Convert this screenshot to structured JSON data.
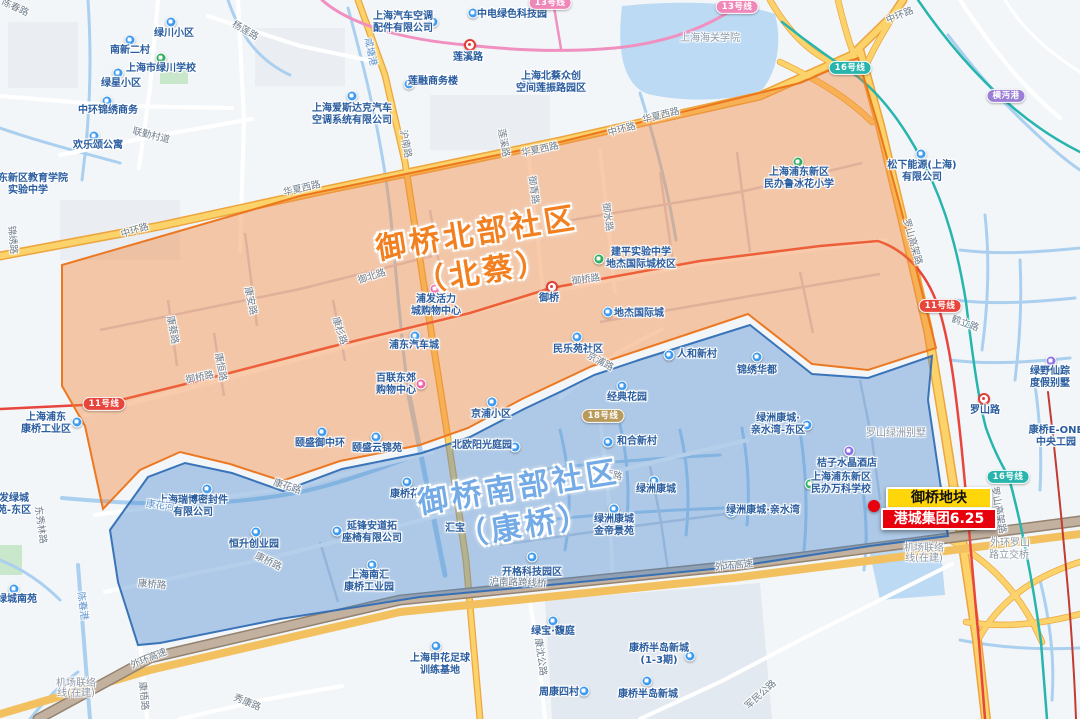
{
  "map": {
    "region_labels": [
      {
        "lines": [
          "御桥北部社区",
          "（北蔡）"
        ],
        "x": 480,
        "y": 253,
        "rot": -9,
        "color": "#f28020"
      },
      {
        "lines": [
          "御桥南部社区",
          "（康桥）"
        ],
        "x": 522,
        "y": 507,
        "rot": -9,
        "color": "#74abe6"
      }
    ],
    "annotation": {
      "dot": {
        "x": 874,
        "y": 506
      },
      "badges": [
        {
          "text": "御桥地块",
          "x": 939,
          "y": 498,
          "w": 102,
          "bg": "#ffd60a",
          "color": "#111111"
        },
        {
          "text": "港城集团6.25",
          "x": 939,
          "y": 519,
          "w": 112,
          "bg": "#e8000d",
          "color": "#ffffff"
        }
      ]
    },
    "stations": [
      {
        "name": "莲溪路",
        "x": 470,
        "y": 45,
        "lx": 468,
        "ly": 58
      },
      {
        "name": "御桥",
        "x": 552,
        "y": 287,
        "lx": 549,
        "ly": 299
      },
      {
        "name": "罗山路",
        "x": 984,
        "y": 399,
        "lx": 985,
        "ly": 411
      }
    ],
    "metro_badges": [
      {
        "t": "11号线",
        "x": 104,
        "y": 404,
        "c": "#e8453c"
      },
      {
        "t": "11号线",
        "x": 940,
        "y": 306,
        "c": "#e8453c"
      },
      {
        "t": "13号线",
        "x": 550,
        "y": 3,
        "c": "#f087b9"
      },
      {
        "t": "13号线",
        "x": 737,
        "y": 7,
        "c": "#f087b9"
      },
      {
        "t": "16号线",
        "x": 850,
        "y": 68,
        "c": "#27b5ad"
      },
      {
        "t": "16号线",
        "x": 1008,
        "y": 477,
        "c": "#27b5ad"
      },
      {
        "t": "18号线",
        "x": 603,
        "y": 416,
        "c": "#b89a5a"
      },
      {
        "t": "横沔港",
        "x": 1006,
        "y": 96,
        "c": "#9b7fd4"
      }
    ],
    "pois": [
      {
        "lines": [
          "南新二村"
        ],
        "x": 130,
        "y": 51,
        "icon": {
          "x": 130,
          "y": 40,
          "type": "building"
        }
      },
      {
        "lines": [
          "绿星小区"
        ],
        "x": 121,
        "y": 84,
        "icon": {
          "x": 118,
          "y": 73,
          "type": "building"
        }
      },
      {
        "lines": [
          "绿川小区"
        ],
        "x": 174,
        "y": 34,
        "icon": {
          "x": 171,
          "y": 22,
          "type": "building"
        }
      },
      {
        "lines": [
          "上海市绿川学校"
        ],
        "x": 161,
        "y": 69,
        "icon": {
          "x": 161,
          "y": 58,
          "type": "school"
        }
      },
      {
        "lines": [
          "中环锦绣商务"
        ],
        "x": 108,
        "y": 111,
        "icon": {
          "x": 107,
          "y": 101,
          "type": "building"
        }
      },
      {
        "lines": [
          "欢乐颂公寓"
        ],
        "x": 98,
        "y": 146,
        "icon": {
          "x": 94,
          "y": 136,
          "type": "building"
        }
      },
      {
        "lines": [
          "浦东新区教育学院",
          "实验中学"
        ],
        "x": 28,
        "y": 179
      },
      {
        "lines": [
          "上海汽车空调",
          "配件有限公司"
        ],
        "x": 403,
        "y": 17,
        "icon": {
          "x": 433,
          "y": 22,
          "type": "building"
        }
      },
      {
        "lines": [
          "中电绿色科技园"
        ],
        "x": 512,
        "y": 15,
        "icon": {
          "x": 473,
          "y": 13,
          "type": "building"
        }
      },
      {
        "lines": [
          "莲融商务楼"
        ],
        "x": 433,
        "y": 82,
        "icon": {
          "x": 409,
          "y": 84,
          "type": "building"
        }
      },
      {
        "lines": [
          "上海北蔡众创",
          "空间莲振路园区"
        ],
        "x": 551,
        "y": 77,
        "icon": {
          "x": 527,
          "y": 80,
          "type": "building"
        }
      },
      {
        "lines": [
          "上海爱斯达克汽车",
          "空调系统有限公司"
        ],
        "x": 352,
        "y": 109,
        "icon": {
          "x": 352,
          "y": 96,
          "type": "building"
        }
      },
      {
        "lines": [
          "松下能源(上海)",
          "有限公司"
        ],
        "x": 922,
        "y": 166,
        "icon": {
          "x": 921,
          "y": 154,
          "type": "building"
        }
      },
      {
        "lines": [
          "上海海关学院"
        ],
        "x": 710,
        "y": 39,
        "type": "gray"
      },
      {
        "lines": [
          "建平实验中学",
          "地杰国际城校区"
        ],
        "x": 641,
        "y": 253,
        "icon": {
          "x": 599,
          "y": 259,
          "type": "school"
        }
      },
      {
        "lines": [
          "上海浦东新区",
          "民办鲁冰花小学"
        ],
        "x": 799,
        "y": 173,
        "icon": {
          "x": 798,
          "y": 162,
          "type": "school"
        }
      },
      {
        "lines": [
          "浦发活力",
          "城购物中心"
        ],
        "x": 436,
        "y": 300,
        "icon": {
          "x": 435,
          "y": 289,
          "type": "mall"
        }
      },
      {
        "lines": [
          "浦东汽车城"
        ],
        "x": 414,
        "y": 346,
        "icon": {
          "x": 415,
          "y": 336,
          "type": "building"
        }
      },
      {
        "lines": [
          "百联东郊",
          "购物中心"
        ],
        "x": 396,
        "y": 379,
        "icon": {
          "x": 421,
          "y": 384,
          "type": "mall"
        }
      },
      {
        "lines": [
          "地杰国际城"
        ],
        "x": 639,
        "y": 314,
        "icon": {
          "x": 608,
          "y": 312,
          "type": "building"
        }
      },
      {
        "lines": [
          "民乐苑社区"
        ],
        "x": 578,
        "y": 350,
        "icon": {
          "x": 577,
          "y": 337,
          "type": "building"
        }
      },
      {
        "lines": [
          "颐盛御中环"
        ],
        "x": 320,
        "y": 444,
        "icon": {
          "x": 322,
          "y": 432,
          "type": "building"
        }
      },
      {
        "lines": [
          "颐盛云锦苑"
        ],
        "x": 377,
        "y": 449,
        "icon": {
          "x": 376,
          "y": 437,
          "type": "building"
        }
      },
      {
        "lines": [
          "上海浦东",
          "康桥工业区"
        ],
        "x": 46,
        "y": 418,
        "icon": {
          "x": 77,
          "y": 422,
          "type": "building"
        }
      },
      {
        "lines": [
          "京浦小区"
        ],
        "x": 491,
        "y": 415,
        "icon": {
          "x": 492,
          "y": 402,
          "type": "building"
        }
      },
      {
        "lines": [
          "人和新村"
        ],
        "x": 697,
        "y": 355,
        "icon": {
          "x": 669,
          "y": 355,
          "type": "building"
        }
      },
      {
        "lines": [
          "锦绣华都"
        ],
        "x": 757,
        "y": 371,
        "icon": {
          "x": 757,
          "y": 357,
          "type": "building"
        }
      },
      {
        "lines": [
          "经典花园"
        ],
        "x": 627,
        "y": 398,
        "icon": {
          "x": 622,
          "y": 386,
          "type": "building"
        }
      },
      {
        "lines": [
          "和合新村"
        ],
        "x": 637,
        "y": 442,
        "icon": {
          "x": 608,
          "y": 442,
          "type": "building"
        }
      },
      {
        "lines": [
          "北欧阳光庭园"
        ],
        "x": 482,
        "y": 446,
        "icon": {
          "x": 515,
          "y": 447,
          "type": "building"
        }
      },
      {
        "lines": [
          "康桥花园"
        ],
        "x": 410,
        "y": 495,
        "icon": {
          "x": 407,
          "y": 482,
          "type": "building"
        }
      },
      {
        "lines": [
          "绿洲康城"
        ],
        "x": 656,
        "y": 490,
        "icon": {
          "x": 654,
          "y": 481,
          "type": "building"
        }
      },
      {
        "lines": [
          "绿洲康城·亲水湾"
        ],
        "x": 763,
        "y": 511,
        "icon": {
          "x": 731,
          "y": 512,
          "type": "building"
        }
      },
      {
        "lines": [
          "绿洲康城·",
          "亲水湾-东区"
        ],
        "x": 778,
        "y": 419,
        "icon": {
          "x": 807,
          "y": 425,
          "type": "building"
        }
      },
      {
        "lines": [
          "桔子水晶酒店"
        ],
        "x": 847,
        "y": 464,
        "icon": {
          "x": 849,
          "y": 451,
          "type": "hotel"
        }
      },
      {
        "lines": [
          "上海浦东新区",
          "民办万科学校"
        ],
        "x": 841,
        "y": 478,
        "icon": {
          "x": 810,
          "y": 484,
          "type": "school"
        }
      },
      {
        "lines": [
          "罗山绿洲别墅"
        ],
        "x": 896,
        "y": 434,
        "type": "gray"
      },
      {
        "lines": [
          "绿洲康城",
          "金帝景苑"
        ],
        "x": 614,
        "y": 520,
        "icon": {
          "x": 614,
          "y": 509,
          "type": "building"
        }
      },
      {
        "lines": [
          "恒升创业园"
        ],
        "x": 254,
        "y": 545,
        "icon": {
          "x": 256,
          "y": 532,
          "type": "building"
        }
      },
      {
        "lines": [
          "延锋安道拓",
          "座椅有限公司"
        ],
        "x": 372,
        "y": 527,
        "icon": {
          "x": 337,
          "y": 531,
          "type": "building"
        }
      },
      {
        "lines": [
          "上海南汇",
          "康桥工业园"
        ],
        "x": 369,
        "y": 576,
        "icon": {
          "x": 372,
          "y": 565,
          "type": "building"
        }
      },
      {
        "lines": [
          "上海瑞博密封件",
          "有限公司"
        ],
        "x": 193,
        "y": 501,
        "icon": {
          "x": 207,
          "y": 489,
          "type": "building"
        }
      },
      {
        "lines": [
          "汇宝"
        ],
        "x": 455,
        "y": 529
      },
      {
        "lines": [
          "开格科技园区"
        ],
        "x": 532,
        "y": 573,
        "icon": {
          "x": 532,
          "y": 557,
          "type": "building"
        }
      },
      {
        "lines": [
          "绿宝·馥庭"
        ],
        "x": 553,
        "y": 632,
        "icon": {
          "x": 553,
          "y": 621,
          "type": "building"
        }
      },
      {
        "lines": [
          "上海申花足球",
          "训练基地"
        ],
        "x": 440,
        "y": 659,
        "icon": {
          "x": 436,
          "y": 646,
          "type": "building"
        }
      },
      {
        "lines": [
          "康桥半岛新城",
          "(1-3期)"
        ],
        "x": 659,
        "y": 649,
        "icon": {
          "x": 690,
          "y": 656,
          "type": "building"
        }
      },
      {
        "lines": [
          "康桥半岛新城"
        ],
        "x": 648,
        "y": 695,
        "icon": {
          "x": 647,
          "y": 681,
          "type": "building"
        }
      },
      {
        "lines": [
          "周康四村"
        ],
        "x": 559,
        "y": 693,
        "icon": {
          "x": 584,
          "y": 691,
          "type": "building"
        }
      },
      {
        "lines": [
          "绿城南苑"
        ],
        "x": 17,
        "y": 600,
        "icon": {
          "x": 14,
          "y": 589,
          "type": "building"
        }
      },
      {
        "lines": [
          "发绿城",
          "苑-东区"
        ],
        "x": 14,
        "y": 499
      },
      {
        "lines": [
          "绿野仙踪",
          "度假别墅"
        ],
        "x": 1050,
        "y": 372,
        "icon": {
          "x": 1051,
          "y": 361,
          "type": "villa"
        }
      },
      {
        "lines": [
          "康桥E-ONE",
          "中央工园"
        ],
        "x": 1056,
        "y": 431
      }
    ],
    "road_labels": [
      {
        "t": "陈春路",
        "x": 15,
        "y": 8,
        "r": 25,
        "type": "road"
      },
      {
        "t": "杨莲路",
        "x": 245,
        "y": 31,
        "r": 30,
        "type": "road"
      },
      {
        "t": "联勤村道",
        "x": 151,
        "y": 136,
        "r": 14,
        "type": "road"
      },
      {
        "t": "锦绣路",
        "x": 12,
        "y": 240,
        "r": 85,
        "type": "road"
      },
      {
        "t": "中环路",
        "x": 135,
        "y": 231,
        "r": -17,
        "type": "road"
      },
      {
        "t": "中环路",
        "x": 622,
        "y": 130,
        "r": -15,
        "type": "road"
      },
      {
        "t": "中环路",
        "x": 900,
        "y": 16,
        "r": -22,
        "type": "road"
      },
      {
        "t": "华夏西路",
        "x": 302,
        "y": 189,
        "r": -13,
        "type": "road"
      },
      {
        "t": "华夏西路",
        "x": 540,
        "y": 150,
        "r": -12,
        "type": "road"
      },
      {
        "t": "华夏西路",
        "x": 661,
        "y": 116,
        "r": -14,
        "type": "road"
      },
      {
        "t": "沪南路",
        "x": 405,
        "y": 144,
        "r": 80,
        "type": "road"
      },
      {
        "t": "莲溪路",
        "x": 503,
        "y": 143,
        "r": 80,
        "type": "road"
      },
      {
        "t": "咸塘港",
        "x": 370,
        "y": 52,
        "r": 78,
        "type": "water"
      },
      {
        "t": "御青路",
        "x": 533,
        "y": 190,
        "r": 82,
        "type": "road"
      },
      {
        "t": "御水路",
        "x": 607,
        "y": 217,
        "r": 82,
        "type": "road"
      },
      {
        "t": "御桥路",
        "x": 586,
        "y": 280,
        "r": -8,
        "type": "road"
      },
      {
        "t": "御桥路",
        "x": 200,
        "y": 378,
        "r": -12,
        "type": "road"
      },
      {
        "t": "御北路",
        "x": 372,
        "y": 277,
        "r": -18,
        "type": "road"
      },
      {
        "t": "康安路",
        "x": 250,
        "y": 301,
        "r": 78,
        "type": "road"
      },
      {
        "t": "康蔡路",
        "x": 172,
        "y": 330,
        "r": 80,
        "type": "road"
      },
      {
        "t": "康恒路",
        "x": 220,
        "y": 367,
        "r": 80,
        "type": "road"
      },
      {
        "t": "康杉路",
        "x": 339,
        "y": 331,
        "r": 72,
        "type": "road"
      },
      {
        "t": "京浦路",
        "x": 600,
        "y": 362,
        "r": 28,
        "type": "road"
      },
      {
        "t": "康桥路",
        "x": 608,
        "y": 475,
        "r": 12,
        "type": "road"
      },
      {
        "t": "康桥路",
        "x": 268,
        "y": 562,
        "r": 26,
        "type": "road"
      },
      {
        "t": "康桥路",
        "x": 152,
        "y": 585,
        "r": 4,
        "type": "road"
      },
      {
        "t": "康花路",
        "x": 287,
        "y": 487,
        "r": 18,
        "type": "road"
      },
      {
        "t": "康花河",
        "x": 160,
        "y": 506,
        "r": 8,
        "type": "water"
      },
      {
        "t": "陈春港",
        "x": 82,
        "y": 606,
        "r": 82,
        "type": "water"
      },
      {
        "t": "东秀林路",
        "x": 40,
        "y": 525,
        "r": 82,
        "type": "road"
      },
      {
        "t": "外环高速",
        "x": 149,
        "y": 659,
        "r": -22,
        "type": "road"
      },
      {
        "t": "外环高速",
        "x": 734,
        "y": 566,
        "r": -6,
        "type": "road"
      },
      {
        "t": "机场联络",
        "x": 76,
        "y": 684,
        "r": 0,
        "type": "gray"
      },
      {
        "t": "线(在建)",
        "x": 76,
        "y": 694,
        "r": 0,
        "type": "gray"
      },
      {
        "t": "机场联络",
        "x": 924,
        "y": 549,
        "r": 0,
        "type": "gray"
      },
      {
        "t": "线(在建)",
        "x": 924,
        "y": 559,
        "r": 0,
        "type": "gray"
      },
      {
        "t": "沪南路跨线桥",
        "x": 518,
        "y": 583,
        "r": 2,
        "type": "road"
      },
      {
        "t": "康沈公路",
        "x": 540,
        "y": 657,
        "r": 82,
        "type": "road"
      },
      {
        "t": "秀康路",
        "x": 247,
        "y": 703,
        "r": 22,
        "type": "road"
      },
      {
        "t": "康梧路",
        "x": 143,
        "y": 696,
        "r": 84,
        "type": "road"
      },
      {
        "t": "军民公路",
        "x": 761,
        "y": 695,
        "r": -42,
        "type": "road"
      },
      {
        "t": "罗山高架路",
        "x": 912,
        "y": 242,
        "r": 74,
        "type": "road"
      },
      {
        "t": "罗山高架路",
        "x": 998,
        "y": 510,
        "r": 80,
        "type": "road"
      },
      {
        "t": "鹤立路",
        "x": 965,
        "y": 324,
        "r": 20,
        "type": "road"
      },
      {
        "t": "外环罗山",
        "x": 1010,
        "y": 544,
        "r": 0,
        "type": "gray"
      },
      {
        "t": "路立交桥",
        "x": 1009,
        "y": 556,
        "r": 0,
        "type": "gray"
      }
    ]
  }
}
